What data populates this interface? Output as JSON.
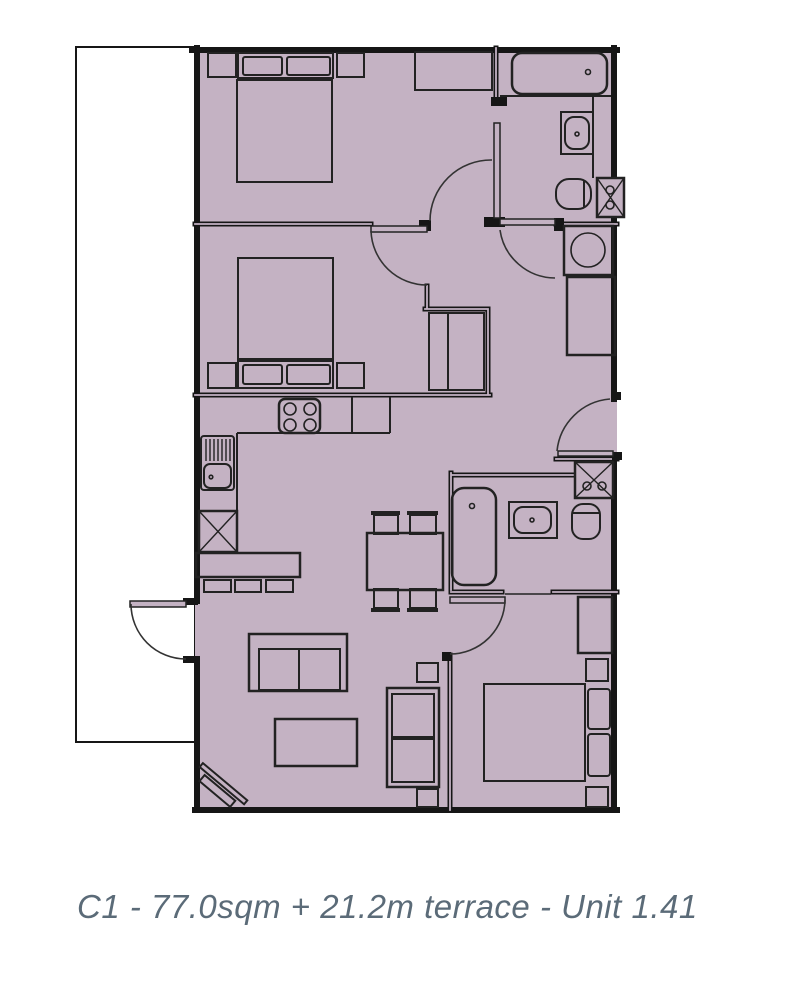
{
  "caption": {
    "text": "C1 - 77.0sqm + 21.2m terrace - Unit 1.41",
    "unit_type": "C1",
    "internal_area": "77.0sqm",
    "terrace_area": "21.2m",
    "unit_number": "Unit 1.41"
  },
  "colors": {
    "background": "#ffffff",
    "floor_fill": "#c4b2c3",
    "terrace_fill": "#ffffff",
    "wall_line": "#161616",
    "furniture_line": "#222222",
    "caption_text": "#5b6b78"
  },
  "plan": {
    "rooms": [
      {
        "name": "terrace",
        "fixtures": []
      },
      {
        "name": "bedroom-1",
        "fixtures": [
          "double-bed",
          "pillows",
          "nightstand-left",
          "nightstand-right",
          "wardrobe"
        ]
      },
      {
        "name": "bedroom-2",
        "fixtures": [
          "double-bed",
          "pillows",
          "nightstand-left",
          "nightstand-right",
          "closet"
        ]
      },
      {
        "name": "bathroom-1",
        "fixtures": [
          "bathtub",
          "washbasin",
          "toilet",
          "service-duct",
          "washing-machine",
          "tall-cupboard"
        ]
      },
      {
        "name": "kitchen",
        "fixtures": [
          "hob",
          "kitchen-sink",
          "dishwasher",
          "counter",
          "breakfast-bar",
          "bar-stools"
        ]
      },
      {
        "name": "dining-area",
        "fixtures": [
          "dining-table",
          "chairs"
        ]
      },
      {
        "name": "living-room",
        "fixtures": [
          "sofa",
          "coffee-table",
          "tv",
          "armchair"
        ]
      },
      {
        "name": "bathroom-2",
        "fixtures": [
          "bathtub",
          "washbasin",
          "toilet",
          "service-duct"
        ]
      },
      {
        "name": "bedroom-3",
        "fixtures": [
          "double-bed",
          "pillows",
          "wardrobe",
          "nightstands"
        ]
      }
    ],
    "doors": [
      "terrace-door",
      "bedroom-2-door",
      "bedroom-1-door",
      "bathroom-1-door",
      "entrance-door",
      "lobby-door",
      "bedroom-3-sliding-door"
    ]
  }
}
